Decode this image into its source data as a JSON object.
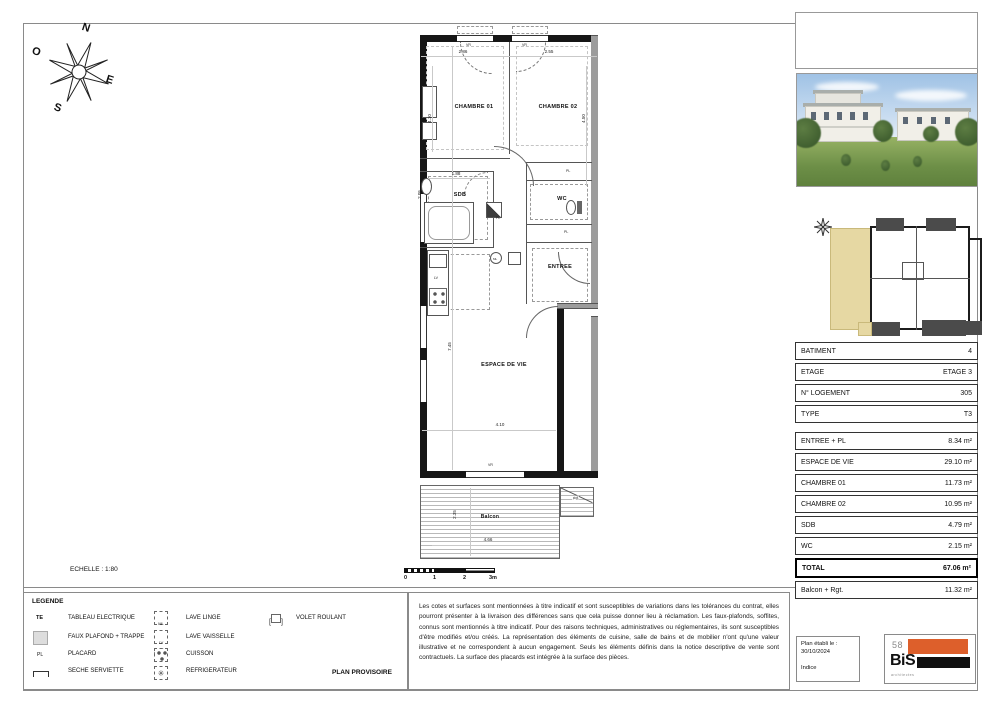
{
  "sheet": {
    "scale_label": "ECHELLE : 1:80",
    "plan_provisoire": "PLAN PROVISOIRE"
  },
  "compass": {
    "n": "N",
    "o": "O",
    "e": "E",
    "s": "S"
  },
  "plan": {
    "rooms": {
      "chambre01": "CHAMBRE 01",
      "chambre02": "CHAMBRE 02",
      "sdb": "SDB",
      "wc": "WC",
      "entree": "ENTREE",
      "espace_de_vie": "ESPACE DE VIE",
      "balcon": "Balcon",
      "rgt": "Rgt"
    },
    "dims": {
      "top_left": "2.86",
      "top_right": "2.55",
      "chambre01_h": "4.10",
      "chambre02_h": "4.50",
      "sdb_w": "1.88",
      "sdb_h": "2.05",
      "vie_h": "7.45",
      "vie_w": "4.10",
      "balcon_w": "4.66",
      "balcon_h": "2.35"
    },
    "labels": {
      "pl": "PL",
      "vr": "VR",
      "ml": "ML",
      "lv": "LV"
    }
  },
  "scalebar": {
    "t0": "0",
    "t1": "1",
    "t2": "2",
    "t3": "3m"
  },
  "info_table": {
    "rows": [
      {
        "label": "BATIMENT",
        "value": "4"
      },
      {
        "label": "ETAGE",
        "value": "ETAGE 3"
      },
      {
        "label": "N° LOGEMENT",
        "value": "305"
      },
      {
        "label": "TYPE",
        "value": "T3"
      },
      {
        "label": "ENTREE + PL",
        "value": "8.34 m²"
      },
      {
        "label": "ESPACE DE VIE",
        "value": "29.10 m²"
      },
      {
        "label": "CHAMBRE 01",
        "value": "11.73 m²"
      },
      {
        "label": "CHAMBRE 02",
        "value": "10.95 m²"
      },
      {
        "label": "SDB",
        "value": "4.79 m²"
      },
      {
        "label": "WC",
        "value": "2.15 m²"
      },
      {
        "label": "TOTAL",
        "value": "67.06 m²"
      },
      {
        "label": "Balcon + Rgt.",
        "value": "11.32 m²"
      }
    ]
  },
  "legend": {
    "title": "LEGENDE",
    "items": [
      {
        "symbol": "TE",
        "label": "TABLEAU ELECTRIQUE"
      },
      {
        "symbol": "",
        "label": "FAUX PLAFOND + TRAPPE"
      },
      {
        "symbol": "PL",
        "label": "PLACARD"
      },
      {
        "symbol": "",
        "label": "SECHE SERVIETTE"
      },
      {
        "symbol": "ML",
        "label": "LAVE LINGE"
      },
      {
        "symbol": "LV",
        "label": "LAVE VAISSELLE"
      },
      {
        "symbol": "",
        "label": "CUISSON"
      },
      {
        "symbol": "",
        "label": "REFRIGERATEUR"
      },
      {
        "symbol": "",
        "label": "VOLET ROULANT"
      }
    ]
  },
  "disclaimer": "Les cotes et surfaces sont mentionnées à titre indicatif et sont susceptibles de variations dans les tolérances du contrat, elles pourront présenter à la livraison des différences sans que cela puisse donner lieu à réclamation. Les faux-plafonds, soffites, connus sont mentionnés à titre indicatif. Pour des raisons techniques, administratives ou réglementaires, ils sont susceptibles d'être modifiés et/ou créés. La représentation des éléments de cuisine, salle de bains et de mobilier n'ont qu'une valeur illustrative et ne correspondent à aucun engagement. Seuls les éléments définis dans la notice descriptive de vente sont contractuels. La surface des placards est intégrée à la surface des pièces.",
  "footer": {
    "date_label": "Plan établi le :",
    "date": "30/10/2024",
    "indice": "Indice",
    "logo_top": "58",
    "logo_main": "BiS",
    "logo_sub": "architectes"
  },
  "colors": {
    "unit_highlight": "#e6d8a3",
    "logo_orange": "#dd5f2b",
    "logo_black": "#101010",
    "wall": "#161616"
  }
}
